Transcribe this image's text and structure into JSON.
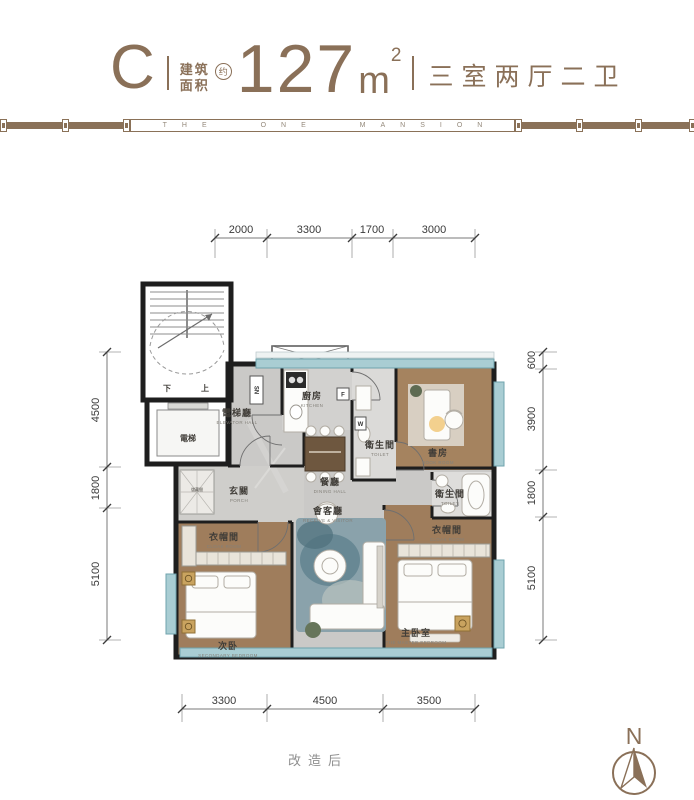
{
  "header": {
    "type": "C",
    "area_name_1": "建筑",
    "area_name_2": "面积",
    "approx": "约",
    "area_value": "127",
    "unit_base": "m",
    "unit_exp": "2",
    "layout": "三室两厅二卫"
  },
  "band": {
    "brand": "THE ONE MANSION"
  },
  "dimensions": {
    "top": [
      "2000",
      "3300",
      "1700",
      "3000"
    ],
    "bottom": [
      "3300",
      "4500",
      "3500"
    ],
    "left": [
      "4500",
      "1800",
      "5100"
    ],
    "right": [
      "600",
      "3900",
      "1800",
      "5100"
    ]
  },
  "rooms": {
    "elevator_hall": {
      "zh": "電梯廳",
      "en": "ELEVATOR HALL"
    },
    "elevator": {
      "zh": "電梯"
    },
    "stair": {
      "down": "下",
      "up": "上"
    },
    "kitchen": {
      "zh": "廚房",
      "en": "KITCHEN"
    },
    "dining": {
      "zh": "餐廳",
      "en": "DINING HALL"
    },
    "toilet_center": {
      "zh": "衛生間",
      "en": "TOILET"
    },
    "book_room": {
      "zh": "書房",
      "en": "BOOK ROOM"
    },
    "toilet_master": {
      "zh": "衛生間",
      "en": "TOILET"
    },
    "porch": {
      "zh": "玄關",
      "en": "PORCH"
    },
    "storage": {
      "zh": "儲藏間"
    },
    "cloak_left": {
      "zh": "衣帽間",
      "en": "CLOAK ROOM"
    },
    "cloak_right": {
      "zh": "衣帽間",
      "en": "CLOAK ROOM"
    },
    "secondary_bedroom": {
      "zh": "次卧",
      "en": "SECONDARY BEDROOM"
    },
    "master_bedroom": {
      "zh": "主卧室",
      "en": "THE MASTER BEDROOM"
    },
    "living": {
      "zh": "會客廳",
      "en": "RECEIVE & VISITOR"
    }
  },
  "markers": {
    "sn": "SN",
    "fridge": "F",
    "washer": "W"
  },
  "footer": {
    "note": "改造后"
  },
  "compass": {
    "north": "N"
  },
  "colors": {
    "brand_brown": "#8a7058",
    "wall_black": "#1e1e1e",
    "floor_gray": "#cac9c7",
    "wood": "#a08060",
    "window_teal": "#a9cdd3",
    "accent_gold": "#c9a35f",
    "rug_blue": "#8aa2ab"
  }
}
